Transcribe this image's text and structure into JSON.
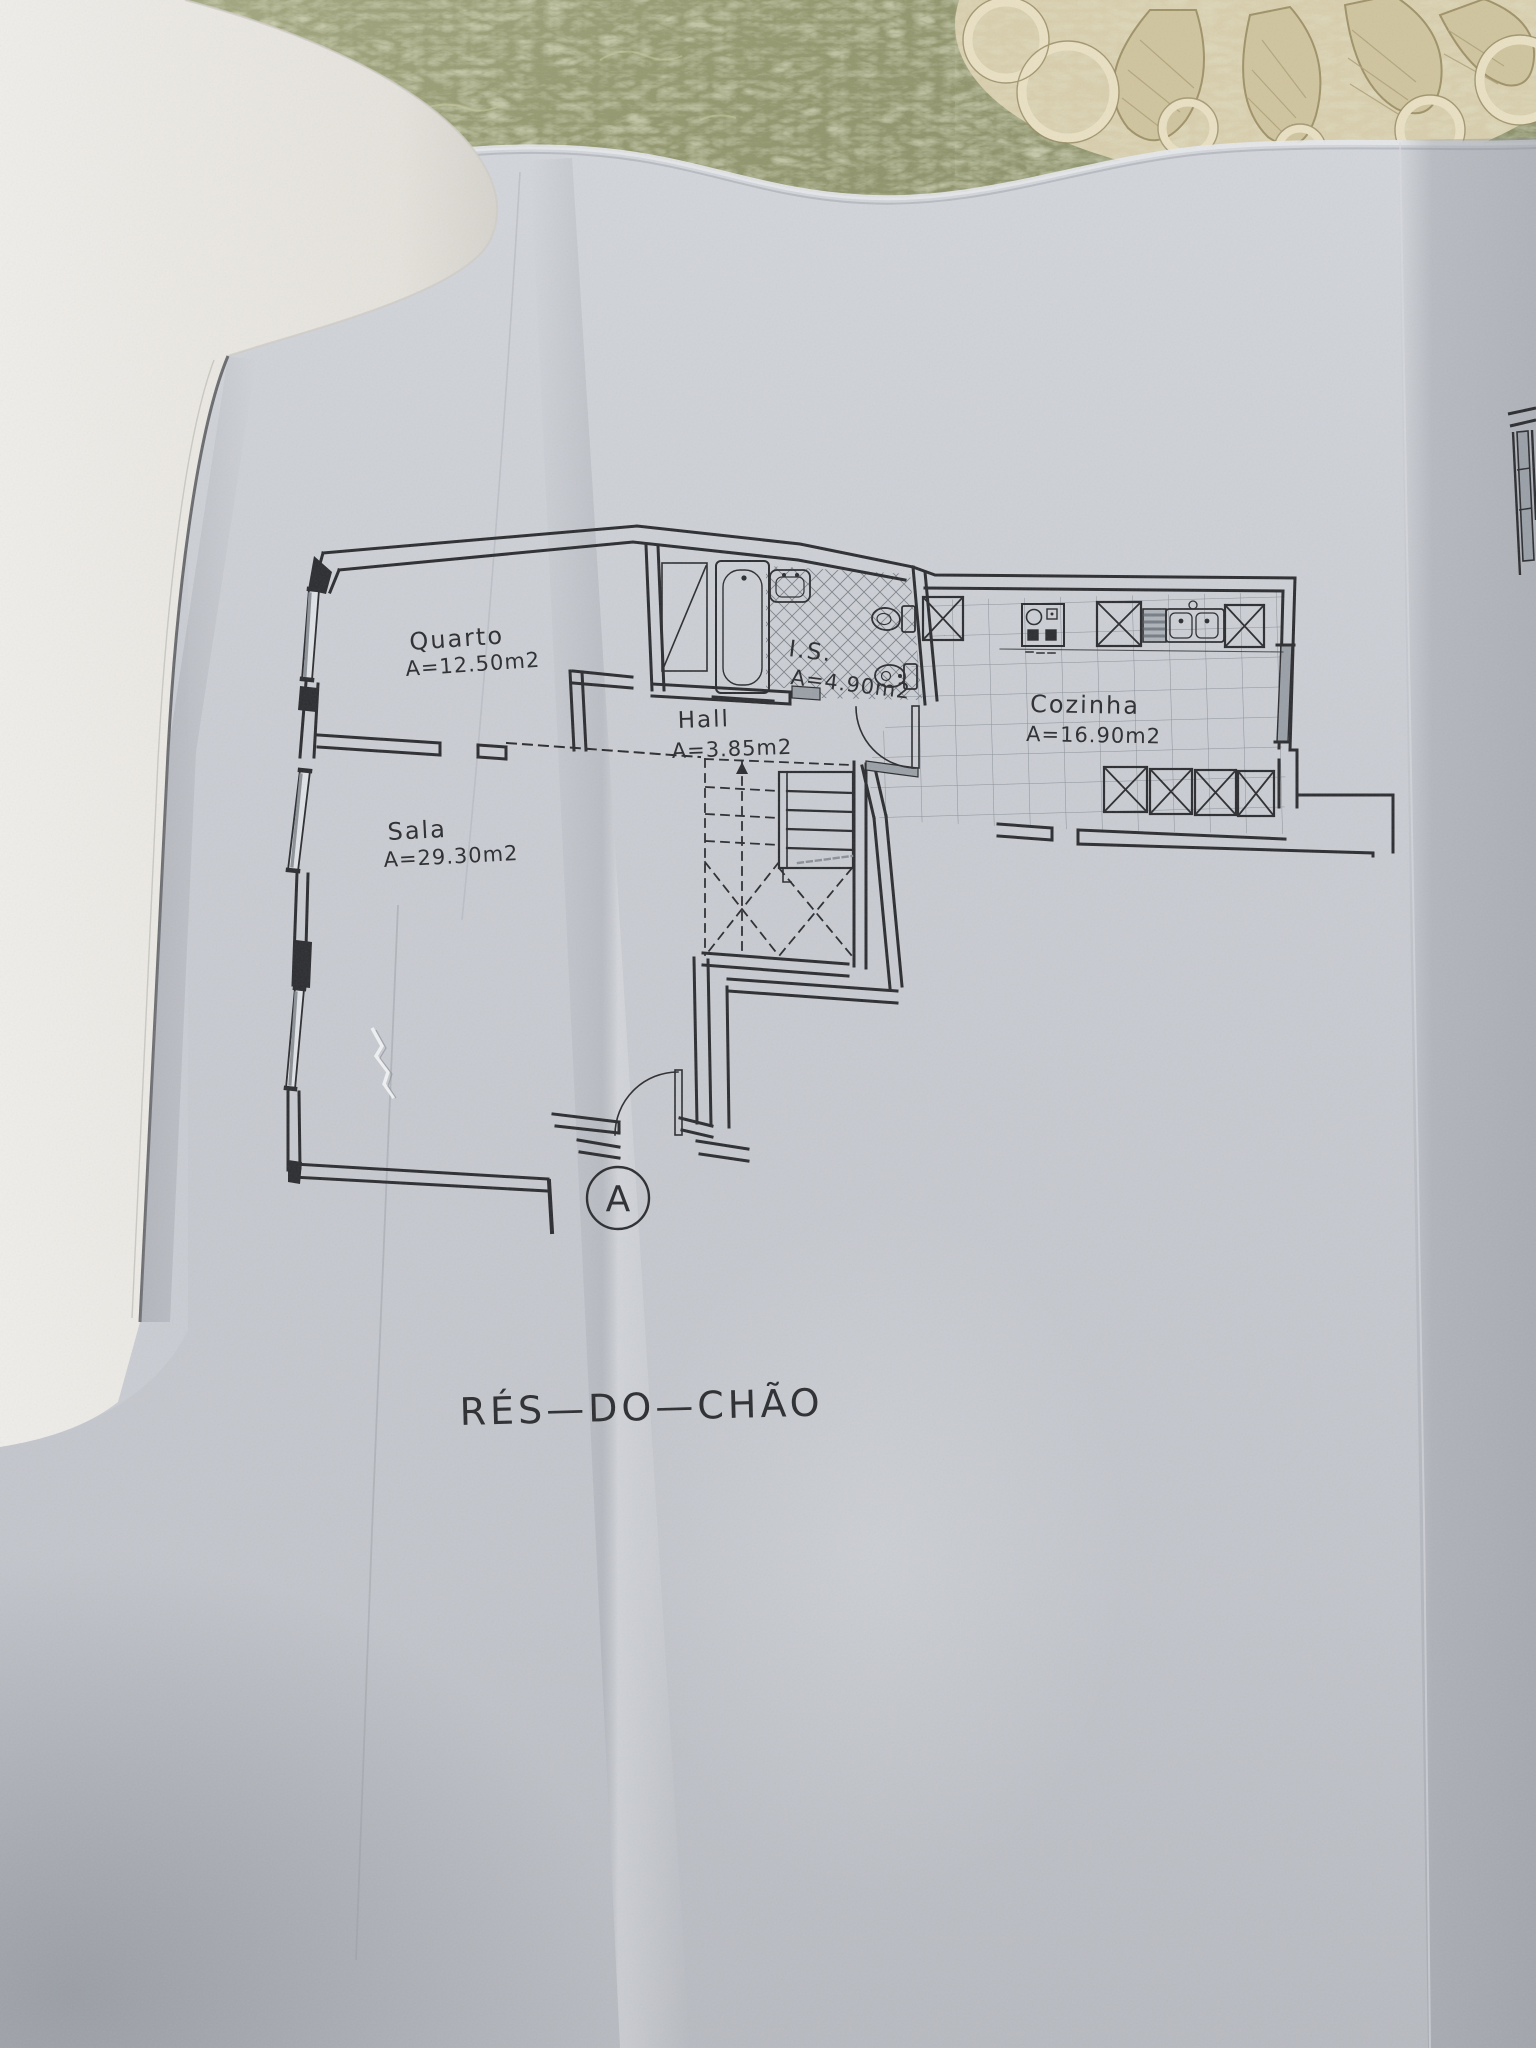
{
  "floor_plan": {
    "title": "RÉS—DO—CHÃO",
    "section_marker": "A",
    "rooms": [
      {
        "id": "quarto",
        "name": "Quarto",
        "area": "A=12.50m2"
      },
      {
        "id": "sala",
        "name": "Sala",
        "area": "A=29.30m2"
      },
      {
        "id": "hall",
        "name": "Hall",
        "area": "A=3.85m2"
      },
      {
        "id": "is",
        "name": "I.S.",
        "area": "A=4.90m2"
      },
      {
        "id": "cozinha",
        "name": "Cozinha",
        "area": "A=16.90m2"
      }
    ],
    "fixtures": [
      {
        "icon": "bathtub-icon"
      },
      {
        "icon": "washbasin-icon"
      },
      {
        "icon": "toilet-icon"
      },
      {
        "icon": "bidet-icon"
      },
      {
        "icon": "shaft-icon"
      },
      {
        "icon": "cooktop-icon"
      },
      {
        "icon": "dishwasher-icon"
      },
      {
        "icon": "double-sink-icon"
      },
      {
        "icon": "appliance-box-icon"
      },
      {
        "icon": "stairs-icon"
      },
      {
        "icon": "door-swing-icon"
      },
      {
        "icon": "window-icon"
      }
    ]
  },
  "colors": {
    "paper": "#c9ccd2",
    "plan_line": "#2c2d31",
    "tablecloth": "#8f946e",
    "doily": "#ddd3b4",
    "page_stack": "#e8e6e1",
    "tile_line": "#868c94",
    "threshold_gray": "#9aa0a7"
  }
}
